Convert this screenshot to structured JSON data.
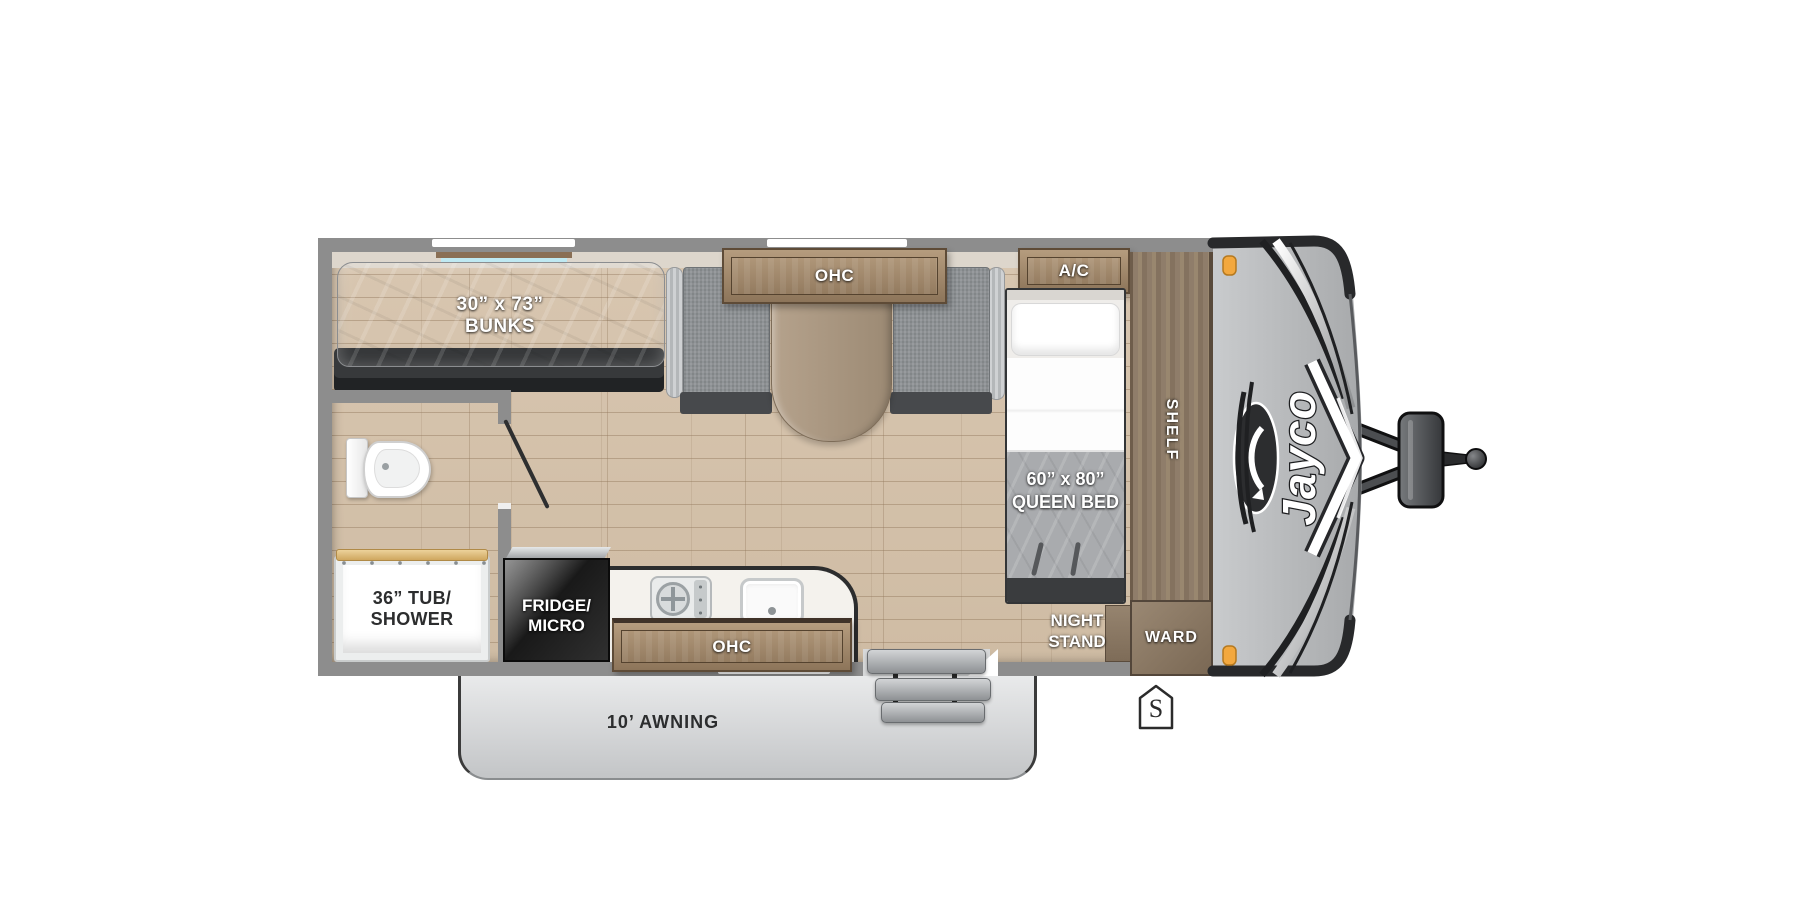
{
  "floorplan": {
    "brand": "Jayco",
    "labels": {
      "bunks": [
        "30” x 73”",
        "BUNKS"
      ],
      "dinette_ohc": "OHC",
      "ac": "A/C",
      "queen_bed": [
        "60” x 80”",
        "QUEEN BED"
      ],
      "shelf": "SHELF",
      "night_stand": [
        "NIGHT",
        "STAND"
      ],
      "ward": "WARD",
      "tub_shower": [
        "36” TUB/",
        "SHOWER"
      ],
      "fridge_micro": [
        "FRIDGE/",
        "MICRO"
      ],
      "kitchen_ohc": "OHC",
      "awning": "10’ AWNING",
      "spare_marker": "S"
    },
    "colors": {
      "wall_gray": "#8d8d8d",
      "floor_wood": "#d5c3ad",
      "cabinet_wood": "#a78f72",
      "cabinet_panel": "#6f5b43",
      "upholstery_gray": "#8f9296",
      "mattress_gray": "#a4a6a8",
      "counter_white": "#f4f2ed",
      "fridge_black": "#1d1d1f",
      "front_cap_gray": "#bdbfc1",
      "marker_light_orange": "#f3a83e"
    }
  }
}
